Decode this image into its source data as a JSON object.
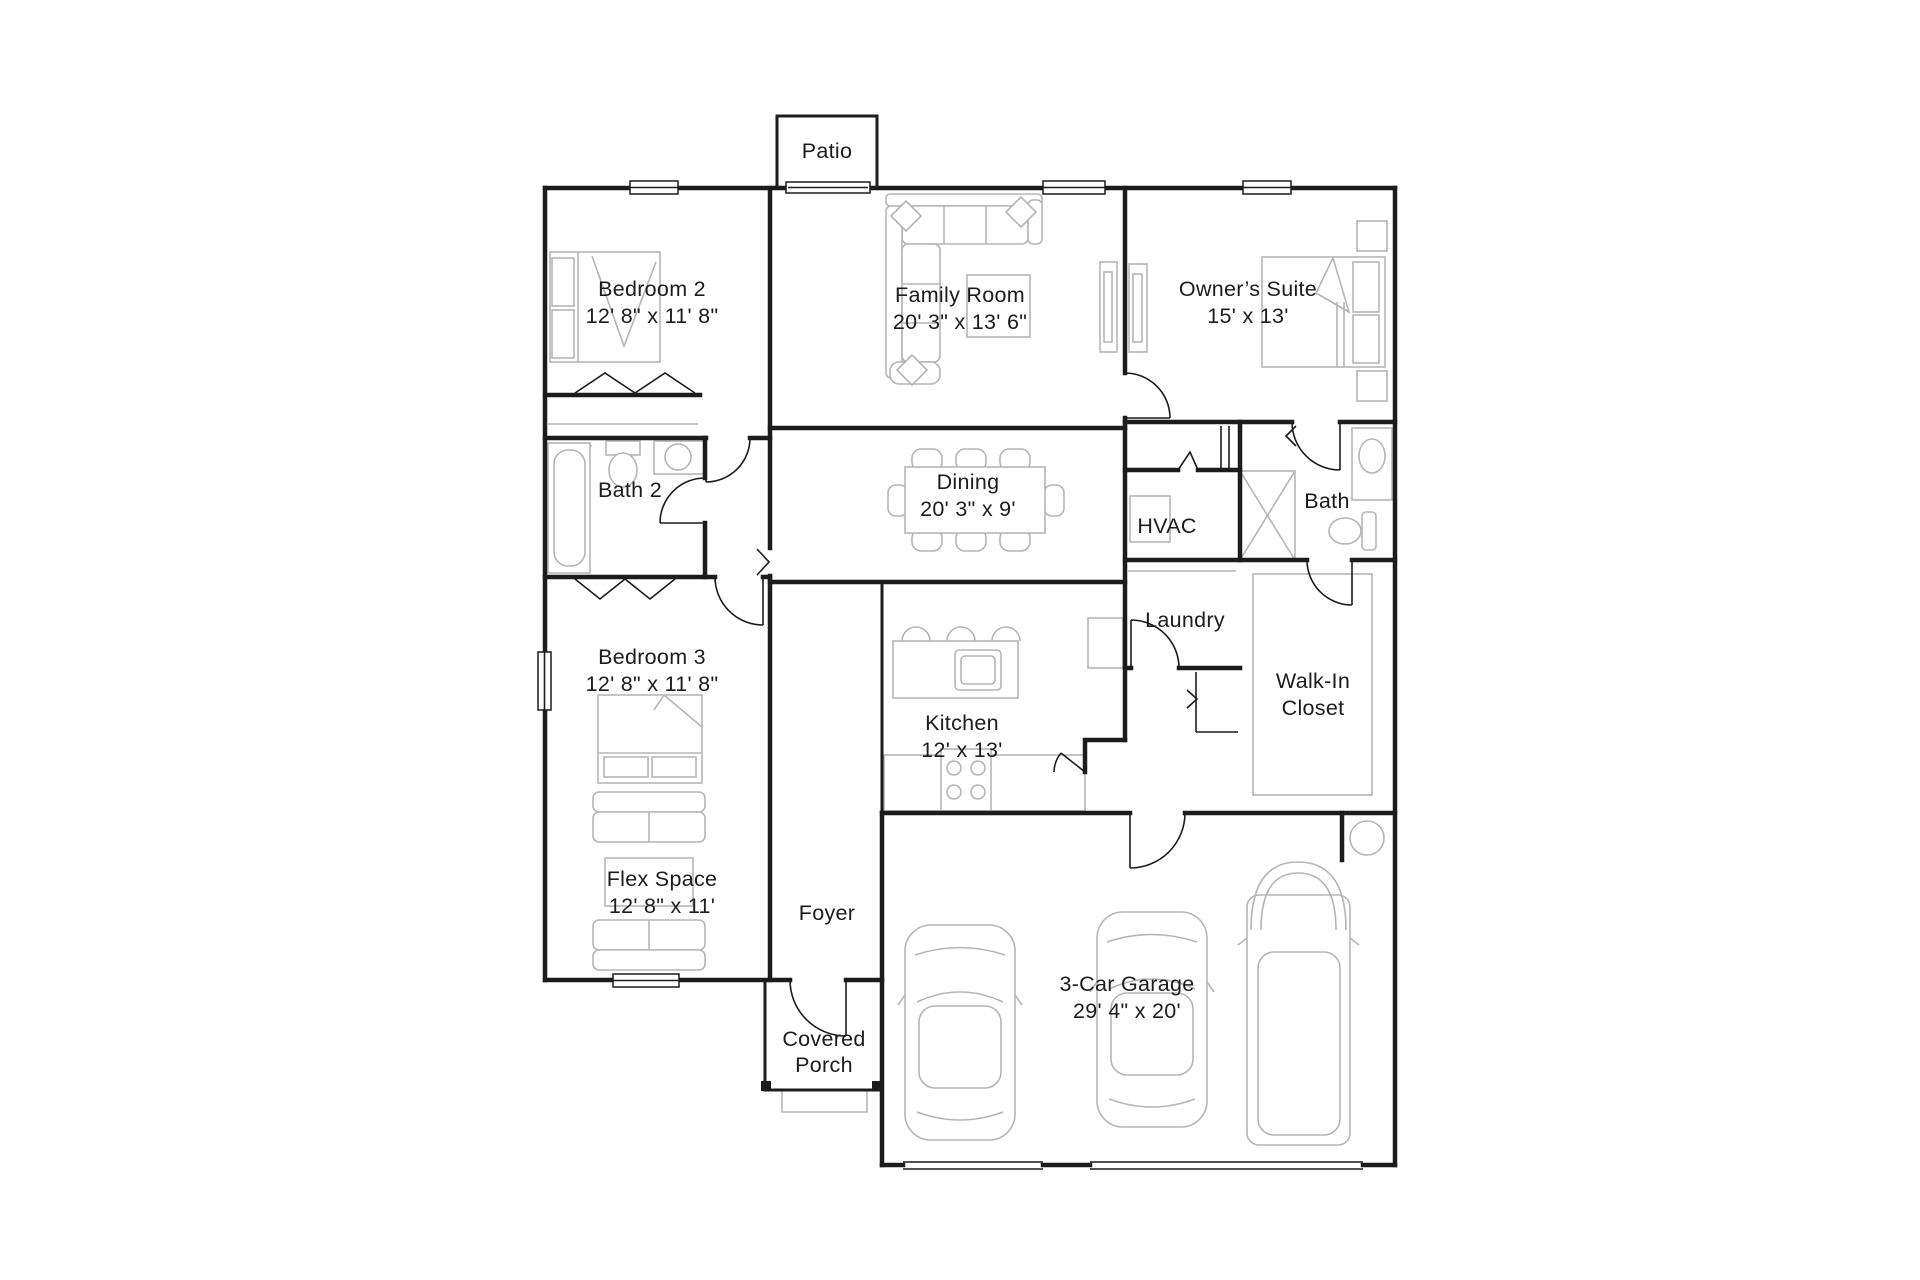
{
  "title": "Single-story floor plan",
  "colors": {
    "background": "#ffffff",
    "walls": "#1c1c1c",
    "furniture": "#b5b5b5",
    "text": "#1c1c1c"
  },
  "rooms": [
    {
      "id": "patio",
      "lines": [
        "Patio"
      ]
    },
    {
      "id": "bedroom-2",
      "lines": [
        "Bedroom 2",
        "12' 8\" x 11' 8\""
      ]
    },
    {
      "id": "family-room",
      "lines": [
        "Family Room",
        "20' 3\" x 13' 6\""
      ]
    },
    {
      "id": "owners-suite",
      "lines": [
        "Owner’s Suite",
        "15' x 13'"
      ]
    },
    {
      "id": "bath-2",
      "lines": [
        "Bath 2"
      ]
    },
    {
      "id": "dining",
      "lines": [
        "Dining",
        "20' 3\" x 9'"
      ]
    },
    {
      "id": "hvac",
      "lines": [
        "HVAC"
      ]
    },
    {
      "id": "bath",
      "lines": [
        "Bath"
      ]
    },
    {
      "id": "laundry",
      "lines": [
        "Laundry"
      ]
    },
    {
      "id": "walk-in-closet",
      "lines": [
        "Walk-In",
        "Closet"
      ]
    },
    {
      "id": "bedroom-3",
      "lines": [
        "Bedroom 3",
        "12' 8\" x 11' 8\""
      ]
    },
    {
      "id": "kitchen",
      "lines": [
        "Kitchen",
        "12' x 13'"
      ]
    },
    {
      "id": "flex-space",
      "lines": [
        "Flex Space",
        "12' 8\" x 11'"
      ]
    },
    {
      "id": "foyer",
      "lines": [
        "Foyer"
      ]
    },
    {
      "id": "covered-porch",
      "lines": [
        "Covered",
        "Porch"
      ]
    },
    {
      "id": "garage",
      "lines": [
        "3-Car Garage",
        "29' 4\" x 20'"
      ]
    }
  ]
}
